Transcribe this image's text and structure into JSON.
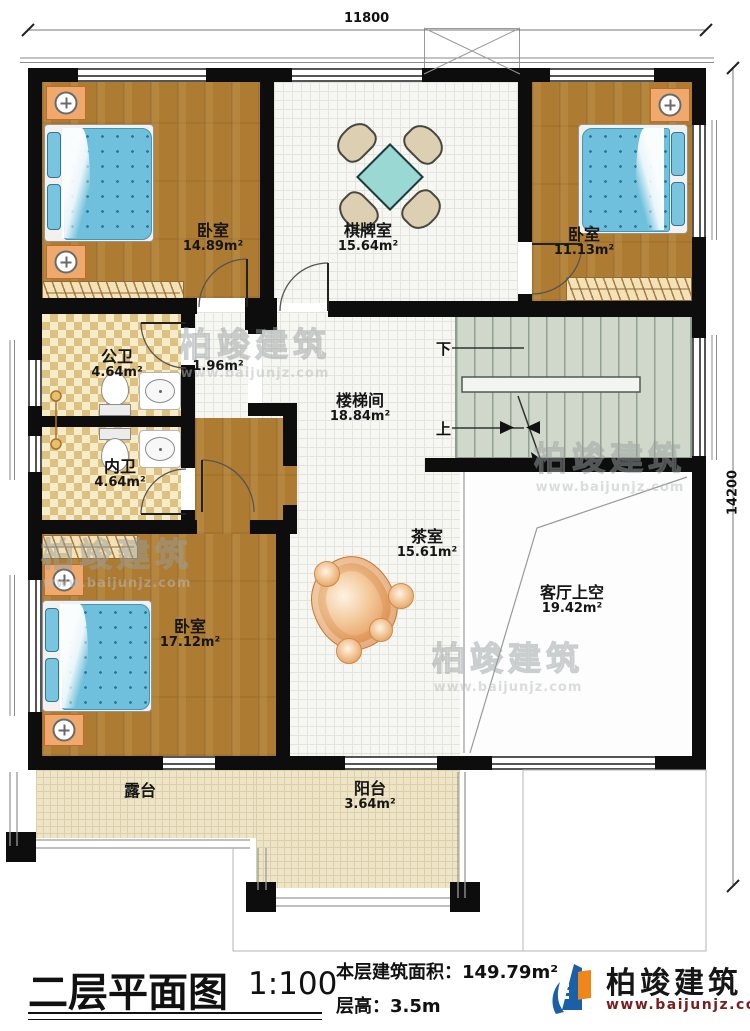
{
  "plan": {
    "sheet_title": "二层平面图",
    "sheet_scale": "1:100",
    "floor_area_label": "本层建筑面积：",
    "floor_area_value": "149.79m²",
    "floor_height_label": "层高：",
    "floor_height_value": "3.5m"
  },
  "dimensions": {
    "top_width": "11800",
    "right_height": "14200"
  },
  "stairs": {
    "down_label": "下",
    "up_label": "上"
  },
  "rooms": [
    {
      "id": "bedroom-top-left",
      "name": "卧室",
      "area": "14.89m²"
    },
    {
      "id": "game-room",
      "name": "棋牌室",
      "area": "15.64m²"
    },
    {
      "id": "bedroom-top-right",
      "name": "卧室",
      "area": "11.13m²"
    },
    {
      "id": "public-bath",
      "name": "公卫",
      "area": "4.64m²"
    },
    {
      "id": "hallway",
      "name": "",
      "area": "1.96m²"
    },
    {
      "id": "stair-hall",
      "name": "楼梯间",
      "area": "18.84m²"
    },
    {
      "id": "private-bath",
      "name": "内卫",
      "area": "4.64m²"
    },
    {
      "id": "bedroom-bottom-left",
      "name": "卧室",
      "area": "17.12m²"
    },
    {
      "id": "tea-room",
      "name": "茶室",
      "area": "15.61m²"
    },
    {
      "id": "living-void",
      "name": "客厅上空",
      "area": "19.42m²"
    },
    {
      "id": "terrace",
      "name": "露台",
      "area": ""
    },
    {
      "id": "balcony",
      "name": "阳台",
      "area": "3.64m²"
    }
  ],
  "brand": {
    "name": "柏竣建筑",
    "website": "www.baijunjz.com"
  },
  "colors": {
    "wall": "#0d0d0d",
    "wood_floor": "#ad7b31",
    "bath_tile": "#dec080",
    "terrace": "#eee4c6",
    "bed_quilt": "#6fc0dc",
    "stair": "#cfd8cb",
    "brand_url_red": "#7a1f1f"
  }
}
